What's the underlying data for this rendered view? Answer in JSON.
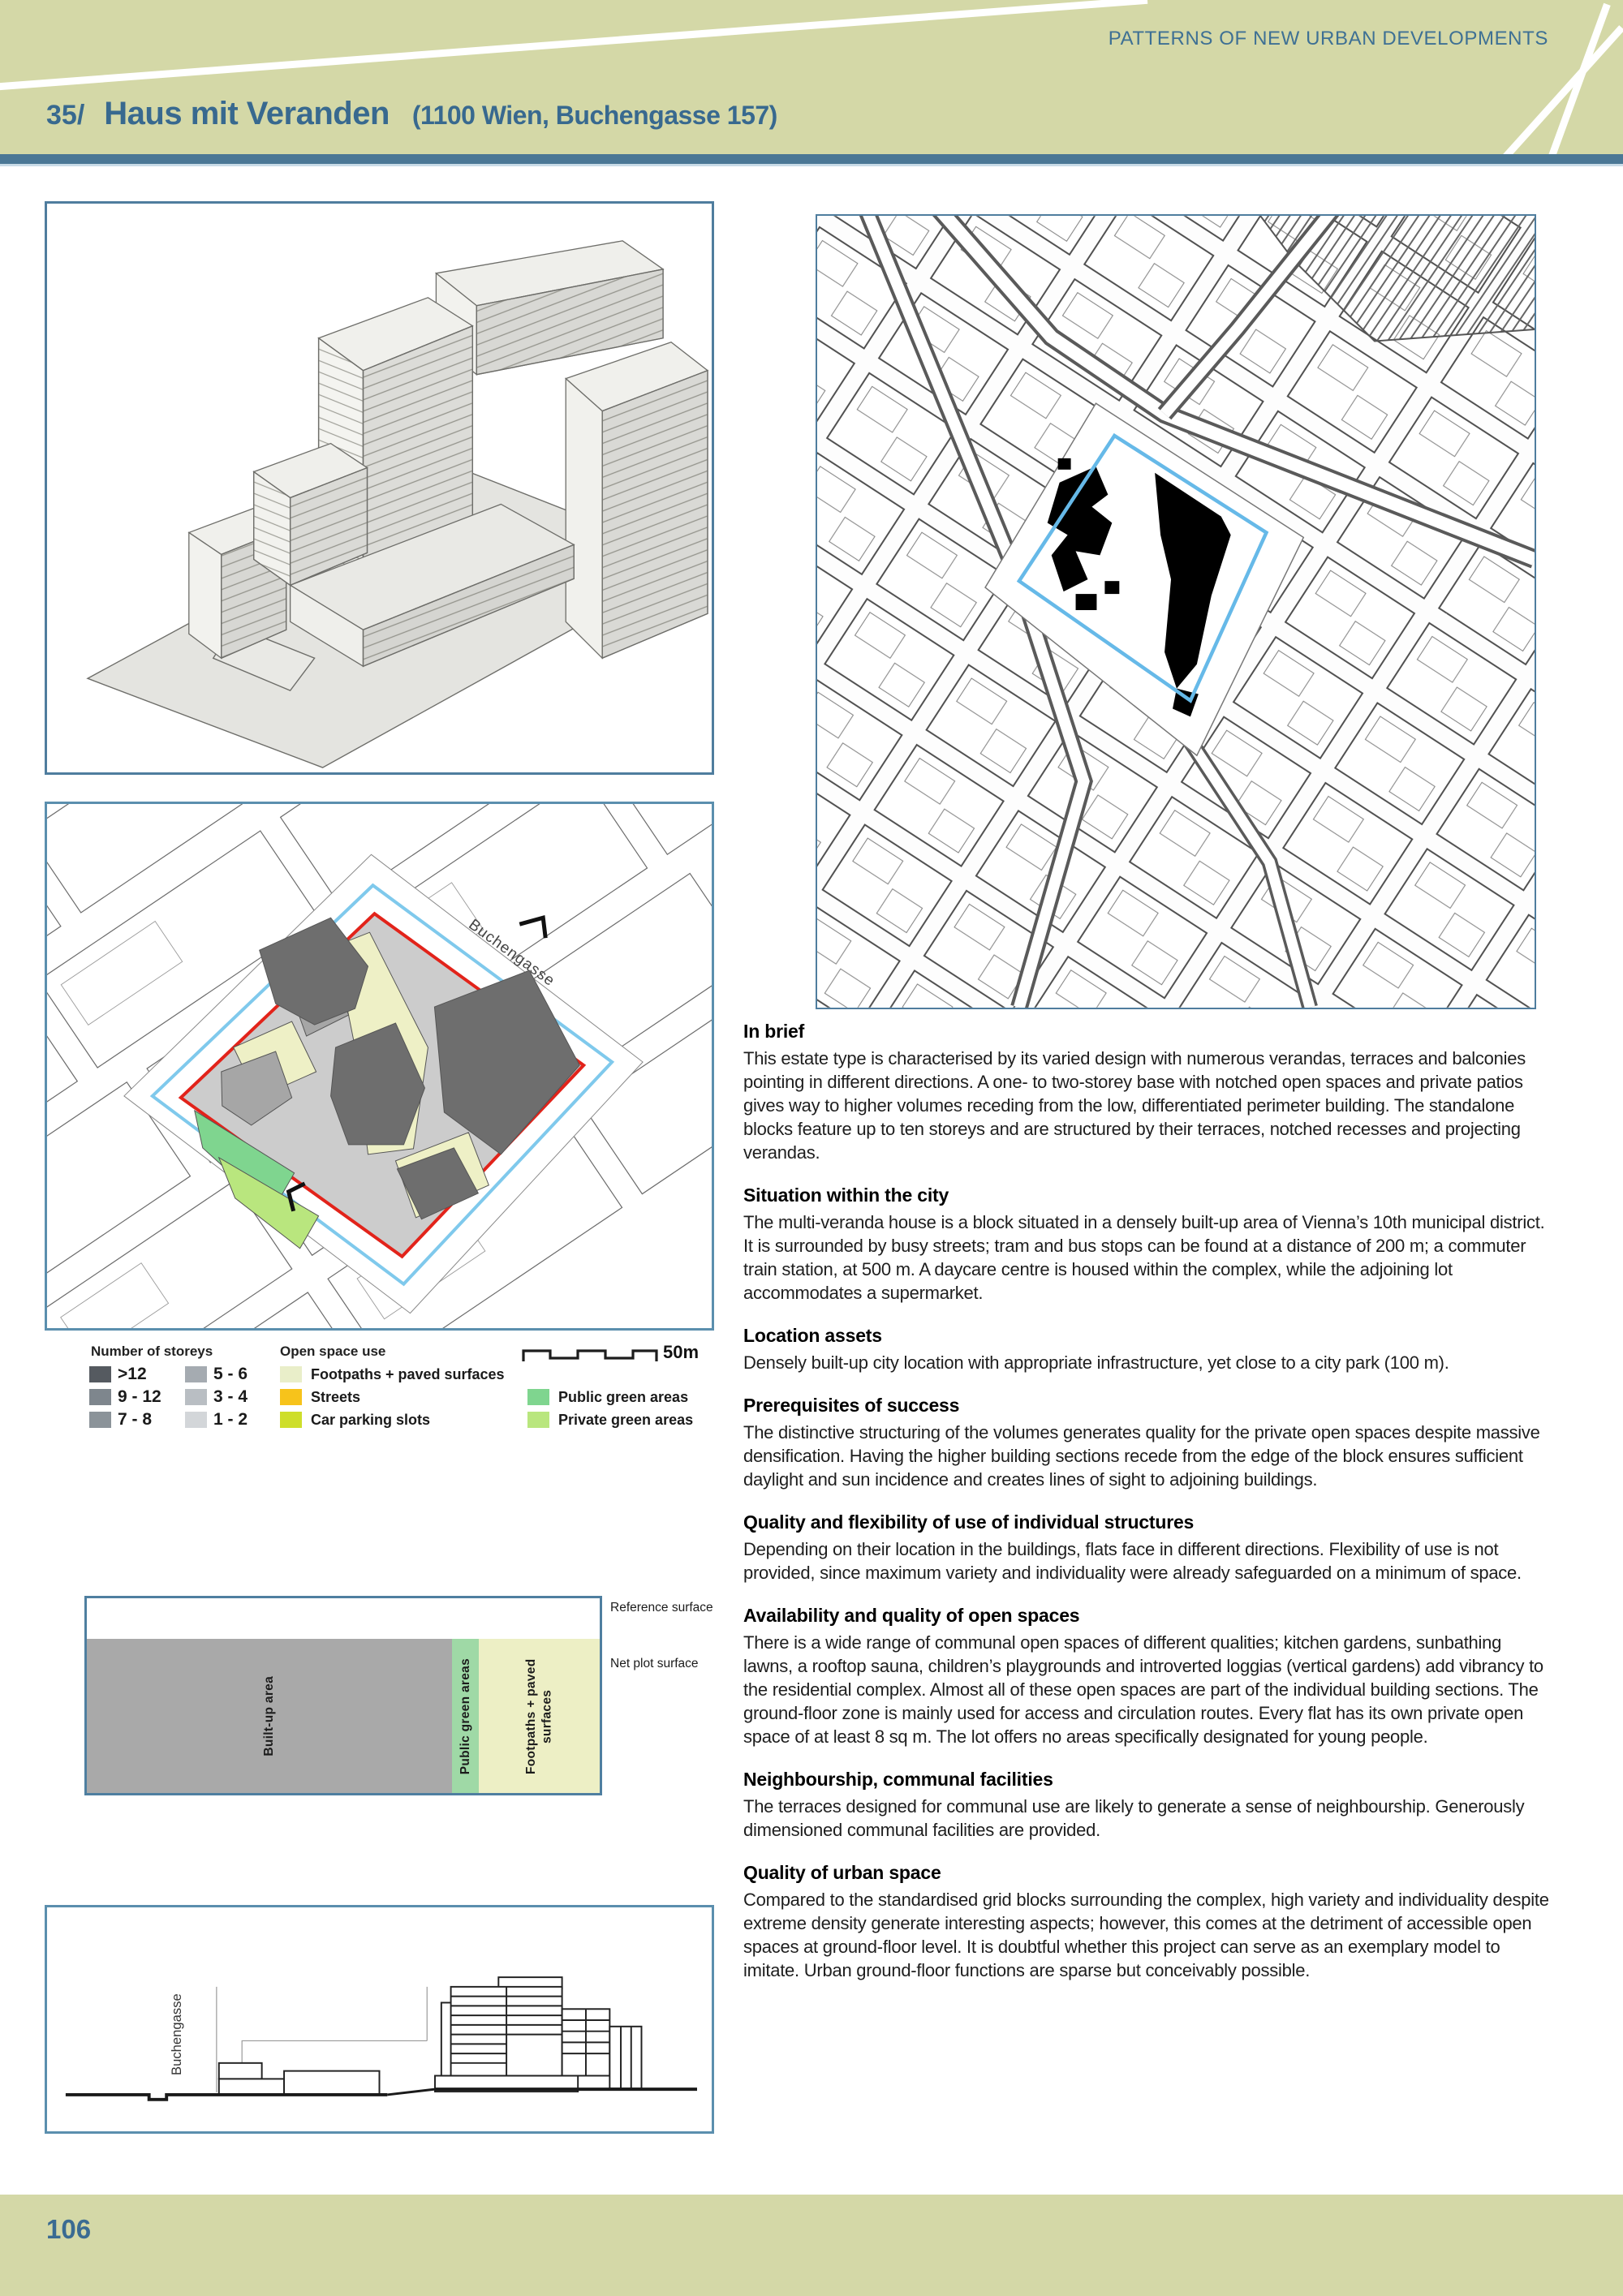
{
  "header": {
    "eyebrow": "PATTERNS OF NEW URBAN DEVELOPMENTS",
    "item_number": "35/",
    "title": "Haus mit Veranden",
    "subtitle": "(1100 Wien, Buchengasse 157)",
    "band_color": "#d4d8a7",
    "accent_color": "#38698f",
    "rule_color": "#4b7795"
  },
  "figures": {
    "site_plan": {
      "street_label": "Buchengasse",
      "plot_outline_outer_color": "#7fc9ec",
      "plot_outline_inner_color": "#e2231a"
    },
    "city_map": {
      "plot_outline_color": "#66b9e8",
      "block_fill_color": "#000000"
    },
    "elevation": {
      "street_label": "Buchengasse"
    }
  },
  "legend": {
    "storeys": {
      "title": "Number of storeys",
      "col1": [
        {
          "label": ">12",
          "color": "#555a60"
        },
        {
          "label": "9 - 12",
          "color": "#7e868d"
        },
        {
          "label": "7 - 8",
          "color": "#8b9399"
        }
      ],
      "col2": [
        {
          "label": "5 - 6",
          "color": "#a5abb1"
        },
        {
          "label": "3 - 4",
          "color": "#b9bec3"
        },
        {
          "label": "1 - 2",
          "color": "#d3d6d9"
        }
      ]
    },
    "open_space": {
      "title": "Open space use",
      "items": [
        {
          "label": "Footpaths + paved surfaces",
          "color": "#e9eec9"
        },
        {
          "label": "Streets",
          "color": "#f7c31b"
        },
        {
          "label": "Car parking slots",
          "color": "#cede2b"
        }
      ]
    },
    "green": [
      {
        "label": "Public green areas",
        "color": "#7fd58f"
      },
      {
        "label": "Private green areas",
        "color": "#b9e67e"
      }
    ],
    "scale_label": "50m"
  },
  "surface_chart": {
    "right_labels": [
      "Reference surface",
      "Net plot surface"
    ],
    "chart_data": {
      "type": "bar",
      "rows": [
        {
          "label": "Reference surface",
          "segments": [
            {
              "label": "",
              "share_pct": 100,
              "color": "#ffffff"
            }
          ]
        },
        {
          "label": "Net plot surface",
          "segments": [
            {
              "label": "Built-up area",
              "share_pct": 71.2,
              "color": "#a9a9a9"
            },
            {
              "label": "Public green areas",
              "share_pct": 5.3,
              "color": "#9fd9a6"
            },
            {
              "label": "Footpaths + paved surfaces",
              "share_pct": 23.5,
              "color": "#edefc5"
            }
          ]
        }
      ]
    }
  },
  "sections": [
    {
      "heading": "In brief",
      "body": "This estate type is characterised by its varied design with numerous verandas, terraces and balconies pointing in different directions. A one- to two-storey base with notched open spaces and private patios gives way to higher volumes receding from the low, differentiated perimeter building. The standalone blocks feature up to ten storeys and are structured by their terraces, notched recesses and projecting verandas."
    },
    {
      "heading": "Situation within the city",
      "body": "The multi-veranda house is a block situated in a densely built-up area of Vienna’s 10th municipal district. It is surrounded by busy streets; tram and bus stops can be found at a distance of 200 m; a commuter train station, at 500 m. A daycare centre is housed within the complex, while the adjoining lot accommodates a supermarket."
    },
    {
      "heading": "Location assets",
      "body": "Densely built-up city location with appropriate infrastructure, yet close to a city park (100 m)."
    },
    {
      "heading": "Prerequisites of success",
      "body": "The distinctive structuring of the volumes generates quality for the private open spaces despite massive densification. Having the higher building sections recede from the edge of the block ensures sufficient daylight and sun incidence and creates lines of sight to adjoining buildings."
    },
    {
      "heading": "Quality and flexibility of use of individual structures",
      "body": "Depending on their location in the buildings, flats face in different directions. Flexibility of use is not provided, since maximum variety and individuality were already safeguarded on a minimum of space."
    },
    {
      "heading": "Availability and quality of open spaces",
      "body": "There is a wide range of communal open spaces of different qualities; kitchen gardens, sunbathing lawns, a rooftop sauna, children’s playgrounds and introverted loggias (vertical gardens) add vibrancy to the residential complex. Almost all of these open spaces are part of the individual building sections. The ground-floor zone is mainly used for access and circulation routes. Every flat has its own private open space of at least 8 sq m. The lot offers no areas specifically designated for young people."
    },
    {
      "heading": "Neighbourship, communal facilities",
      "body": "The terraces designed for communal use are likely to generate a sense of neighbourship. Generously dimensioned communal facilities are provided."
    },
    {
      "heading": "Quality of urban space",
      "body": "Compared to the standardised grid blocks surrounding the complex, high variety and individuality despite extreme density generate interesting aspects; however, this comes at the detriment of accessible open spaces at ground-floor level. It is doubtful whether this project can serve as an exemplary model to imitate. Urban ground-floor functions are sparse but conceivably possible."
    }
  ],
  "footer": {
    "page_number": "106"
  }
}
